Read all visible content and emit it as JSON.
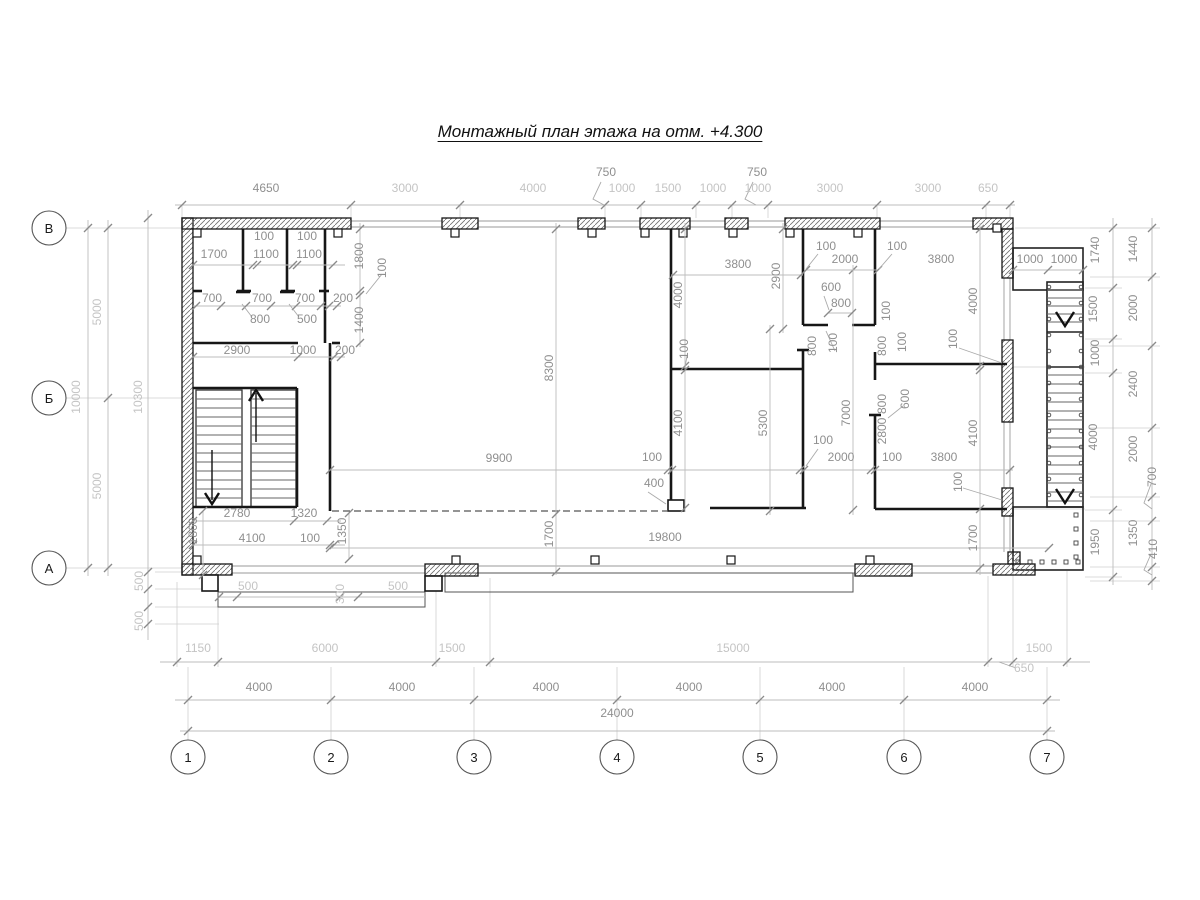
{
  "title": "Монтажный план этажа на отм. +4.300",
  "colors": {
    "wall_outline": "#161616",
    "hatch": "#6e6e6e",
    "dim_text": "#8f8f8f",
    "dim_text_light": "#c4c4c4",
    "dim_line": "#bdbdbd",
    "tick": "#8a8a8a",
    "ext_line": "#cfcfcf",
    "background": "#ffffff"
  },
  "axes": {
    "bottom": {
      "y": 757,
      "r": 17,
      "items": [
        {
          "label": "1",
          "x": 188
        },
        {
          "label": "2",
          "x": 331
        },
        {
          "label": "3",
          "x": 474
        },
        {
          "label": "4",
          "x": 617
        },
        {
          "label": "5",
          "x": 760
        },
        {
          "label": "6",
          "x": 904
        },
        {
          "label": "7",
          "x": 1047
        }
      ]
    },
    "left": {
      "x": 49,
      "r": 17,
      "items": [
        {
          "label": "В",
          "y": 228
        },
        {
          "label": "Б",
          "y": 398
        },
        {
          "label": "А",
          "y": 568
        }
      ]
    }
  },
  "dim_labels": [
    {
      "t": "4650",
      "x": 266,
      "y": 192
    },
    {
      "t": "3000",
      "x": 405,
      "y": 192,
      "cls": "l"
    },
    {
      "t": "4000",
      "x": 533,
      "y": 192,
      "cls": "l"
    },
    {
      "t": "750",
      "x": 606,
      "y": 176
    },
    {
      "t": "1000",
      "x": 622,
      "y": 192,
      "cls": "l"
    },
    {
      "t": "1500",
      "x": 668,
      "y": 192,
      "cls": "l"
    },
    {
      "t": "1000",
      "x": 713,
      "y": 192,
      "cls": "l"
    },
    {
      "t": "750",
      "x": 757,
      "y": 176
    },
    {
      "t": "1000",
      "x": 758,
      "y": 192,
      "cls": "l"
    },
    {
      "t": "3000",
      "x": 830,
      "y": 192,
      "cls": "l"
    },
    {
      "t": "3000",
      "x": 928,
      "y": 192,
      "cls": "l"
    },
    {
      "t": "650",
      "x": 988,
      "y": 192,
      "cls": "l"
    },
    {
      "t": "5000",
      "x": 101,
      "y": 312,
      "rot": 1,
      "cls": "l"
    },
    {
      "t": "10000",
      "x": 80,
      "y": 397,
      "rot": 1,
      "cls": "l"
    },
    {
      "t": "5000",
      "x": 101,
      "y": 486,
      "rot": 1,
      "cls": "l"
    },
    {
      "t": "10300",
      "x": 142,
      "y": 397,
      "rot": 1,
      "cls": "l"
    },
    {
      "t": "500",
      "x": 143,
      "y": 581,
      "rot": 1,
      "cls": "l"
    },
    {
      "t": "500",
      "x": 143,
      "y": 621,
      "rot": 1,
      "cls": "l"
    },
    {
      "t": "1740",
      "x": 1099,
      "y": 250,
      "rot": 1
    },
    {
      "t": "1500",
      "x": 1097,
      "y": 309,
      "rot": 1
    },
    {
      "t": "1000",
      "x": 1099,
      "y": 353,
      "rot": 1
    },
    {
      "t": "4000",
      "x": 1097,
      "y": 437,
      "rot": 1
    },
    {
      "t": "1950",
      "x": 1099,
      "y": 542,
      "rot": 1
    },
    {
      "t": "1440",
      "x": 1137,
      "y": 249,
      "rot": 1
    },
    {
      "t": "2000",
      "x": 1137,
      "y": 308,
      "rot": 1
    },
    {
      "t": "2400",
      "x": 1137,
      "y": 384,
      "rot": 1
    },
    {
      "t": "2000",
      "x": 1137,
      "y": 449,
      "rot": 1
    },
    {
      "t": "700",
      "x": 1156,
      "y": 477,
      "rot": 1
    },
    {
      "t": "1350",
      "x": 1137,
      "y": 533,
      "rot": 1
    },
    {
      "t": "410",
      "x": 1157,
      "y": 549,
      "rot": 1
    },
    {
      "t": "1150",
      "x": 198,
      "y": 652,
      "cls": "l"
    },
    {
      "t": "6000",
      "x": 325,
      "y": 652,
      "cls": "l"
    },
    {
      "t": "1500",
      "x": 452,
      "y": 652,
      "cls": "l"
    },
    {
      "t": "15000",
      "x": 733,
      "y": 652,
      "cls": "l"
    },
    {
      "t": "1500",
      "x": 1039,
      "y": 652,
      "cls": "l"
    },
    {
      "t": "650",
      "x": 1024,
      "y": 672,
      "cls": "l"
    },
    {
      "t": "4000",
      "x": 259,
      "y": 691
    },
    {
      "t": "4000",
      "x": 402,
      "y": 691
    },
    {
      "t": "4000",
      "x": 546,
      "y": 691
    },
    {
      "t": "4000",
      "x": 689,
      "y": 691
    },
    {
      "t": "4000",
      "x": 832,
      "y": 691
    },
    {
      "t": "4000",
      "x": 975,
      "y": 691
    },
    {
      "t": "24000",
      "x": 617,
      "y": 717
    },
    {
      "t": "500",
      "x": 248,
      "y": 590,
      "cls": "l"
    },
    {
      "t": "300",
      "x": 344,
      "y": 594,
      "rot": 1,
      "cls": "l"
    },
    {
      "t": "500",
      "x": 398,
      "y": 590,
      "cls": "l"
    },
    {
      "t": "100",
      "x": 264,
      "y": 240
    },
    {
      "t": "100",
      "x": 307,
      "y": 240
    },
    {
      "t": "1700",
      "x": 214,
      "y": 258
    },
    {
      "t": "1100",
      "x": 266,
      "y": 258
    },
    {
      "t": "1100",
      "x": 309,
      "y": 258
    },
    {
      "t": "700",
      "x": 212,
      "y": 302
    },
    {
      "t": "700",
      "x": 262,
      "y": 302
    },
    {
      "t": "700",
      "x": 305,
      "y": 302
    },
    {
      "t": "200",
      "x": 343,
      "y": 302
    },
    {
      "t": "800",
      "x": 260,
      "y": 323
    },
    {
      "t": "500",
      "x": 307,
      "y": 323
    },
    {
      "t": "1800",
      "x": 363,
      "y": 256,
      "rot": 1
    },
    {
      "t": "100",
      "x": 386,
      "y": 268,
      "rot": 1
    },
    {
      "t": "1400",
      "x": 363,
      "y": 320,
      "rot": 1
    },
    {
      "t": "2900",
      "x": 237,
      "y": 354
    },
    {
      "t": "1000",
      "x": 303,
      "y": 354
    },
    {
      "t": "200",
      "x": 345,
      "y": 354
    },
    {
      "t": "2780",
      "x": 237,
      "y": 517
    },
    {
      "t": "1320",
      "x": 304,
      "y": 517
    },
    {
      "t": "1860",
      "x": 197,
      "y": 531,
      "rot": 1
    },
    {
      "t": "1350",
      "x": 346,
      "y": 531,
      "rot": 1
    },
    {
      "t": "4100",
      "x": 252,
      "y": 542
    },
    {
      "t": "100",
      "x": 310,
      "y": 542
    },
    {
      "t": "8300",
      "x": 553,
      "y": 368,
      "rot": 1
    },
    {
      "t": "9900",
      "x": 499,
      "y": 462
    },
    {
      "t": "1700",
      "x": 553,
      "y": 534,
      "rot": 1
    },
    {
      "t": "19800",
      "x": 665,
      "y": 541
    },
    {
      "t": "100",
      "x": 652,
      "y": 461
    },
    {
      "t": "400",
      "x": 654,
      "y": 487
    },
    {
      "t": "4000",
      "x": 682,
      "y": 295,
      "rot": 1
    },
    {
      "t": "100",
      "x": 688,
      "y": 349,
      "rot": 1
    },
    {
      "t": "4100",
      "x": 682,
      "y": 423,
      "rot": 1
    },
    {
      "t": "3800",
      "x": 738,
      "y": 268
    },
    {
      "t": "5300",
      "x": 767,
      "y": 423,
      "rot": 1
    },
    {
      "t": "2900",
      "x": 780,
      "y": 276,
      "rot": 1
    },
    {
      "t": "100",
      "x": 826,
      "y": 250
    },
    {
      "t": "2000",
      "x": 845,
      "y": 263
    },
    {
      "t": "600",
      "x": 831,
      "y": 291
    },
    {
      "t": "800",
      "x": 841,
      "y": 307
    },
    {
      "t": "800",
      "x": 816,
      "y": 346,
      "rot": 1
    },
    {
      "t": "100",
      "x": 837,
      "y": 343,
      "rot": 1
    },
    {
      "t": "100",
      "x": 823,
      "y": 444
    },
    {
      "t": "7000",
      "x": 850,
      "y": 413,
      "rot": 1
    },
    {
      "t": "100",
      "x": 890,
      "y": 311,
      "rot": 1
    },
    {
      "t": "800",
      "x": 886,
      "y": 346,
      "rot": 1
    },
    {
      "t": "100",
      "x": 906,
      "y": 342,
      "rot": 1
    },
    {
      "t": "600",
      "x": 909,
      "y": 399,
      "rot": 1
    },
    {
      "t": "800",
      "x": 886,
      "y": 404,
      "rot": 1
    },
    {
      "t": "2800",
      "x": 886,
      "y": 431,
      "rot": 1
    },
    {
      "t": "100",
      "x": 957,
      "y": 339,
      "rot": 1
    },
    {
      "t": "100",
      "x": 892,
      "y": 461
    },
    {
      "t": "3800",
      "x": 944,
      "y": 461
    },
    {
      "t": "2000",
      "x": 841,
      "y": 461
    },
    {
      "t": "100",
      "x": 962,
      "y": 482,
      "rot": 1
    },
    {
      "t": "4000",
      "x": 977,
      "y": 301,
      "rot": 1
    },
    {
      "t": "4100",
      "x": 977,
      "y": 433,
      "rot": 1
    },
    {
      "t": "1700",
      "x": 977,
      "y": 538,
      "rot": 1
    },
    {
      "t": "100",
      "x": 897,
      "y": 250
    },
    {
      "t": "3800",
      "x": 941,
      "y": 263
    },
    {
      "t": "1000",
      "x": 1030,
      "y": 263
    },
    {
      "t": "1000",
      "x": 1064,
      "y": 263
    }
  ]
}
